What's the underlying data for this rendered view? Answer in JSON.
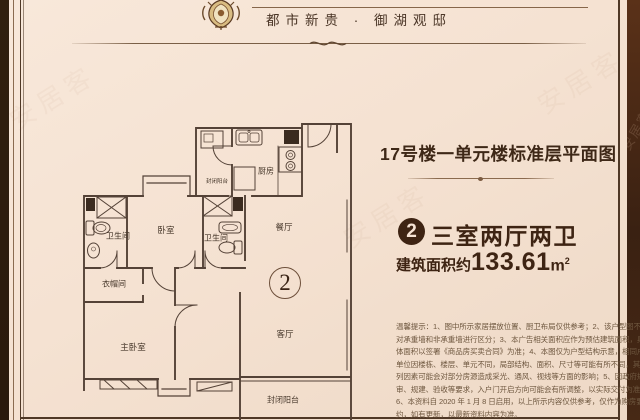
{
  "header": {
    "brand": "都市新贵 · 御湖观邸"
  },
  "panel": {
    "title": "17号楼一单元楼标准层平面图",
    "badge": "2",
    "room_type": "三室两厅两卫",
    "area_label": "建筑面积约",
    "area_value": "133.61",
    "area_unit": "m",
    "area_unit_sup": "2"
  },
  "plan": {
    "unit_number": "2",
    "rooms": [
      {
        "label": "封闭阳台"
      },
      {
        "label": "厨房"
      },
      {
        "label": "卫生间"
      },
      {
        "label": "卧室"
      },
      {
        "label": "卫生间"
      },
      {
        "label": "餐厅"
      },
      {
        "label": "衣帽间"
      },
      {
        "label": "主卧室"
      },
      {
        "label": "客厅"
      },
      {
        "label": "封闭阳台"
      }
    ]
  },
  "disclaimer": {
    "lines": [
      "温馨提示：1、图中所示家居摆放位置、厨卫布局仅供参考；2、该户型图不",
      "对承重墙和非承重墙进行区分；3、本广告相关面积应作为预估建筑面积，具",
      "体面积以签署《商品房买卖合同》为准；4、本图仅为户型结构示意，相同户型",
      "单位因楼栋、楼层、单元不同，局部结构、面积、尺寸等可能有所不同，其中所",
      "列因素可能会对部分房源造成采光、通风、视线等方面的影响；5、因政府规",
      "审、规建、验收等要求，入户门开启方向可能会有所调整，以实际交付为准；",
      "6、本资料自 2020 年 1 月 8 日启用，以上所示内容仅供参考，仅作为购房要",
      "约，如有更新，以最新资料内容为准。"
    ]
  },
  "watermark_text": "安居客",
  "colors": {
    "background": "#f5e2d2",
    "frame": "#2c1a0d",
    "ink": "#3e2413",
    "plan_line": "#544237",
    "disclaimer_text": "#6e573f"
  }
}
